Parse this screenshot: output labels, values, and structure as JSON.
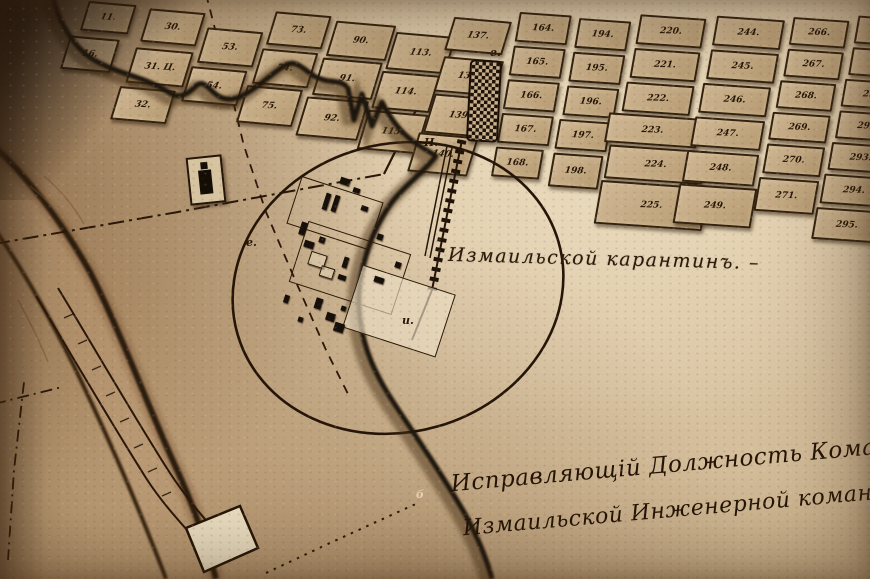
{
  "palette": {
    "paper": "#d9c3a2",
    "paper_light": "#e6d6b8",
    "paper_dark": "#ad8d67",
    "block_fill": "#c3a982",
    "ink": "#2a1708",
    "shadow": "#1a110a"
  },
  "labels": {
    "quarantine": "Измаильской карантинъ. –",
    "signature_line1": "Исправляющій Должность Командир",
    "signature_line2": "Измаильской Инженерной команды в"
  },
  "letter_marks": [
    {
      "text": "е.",
      "x": 490,
      "y": 46,
      "light": false
    },
    {
      "text": "Н.",
      "x": 424,
      "y": 136,
      "light": false
    },
    {
      "text": "и.",
      "x": 402,
      "y": 314,
      "light": false
    },
    {
      "text": "е.",
      "x": 246,
      "y": 236,
      "light": false
    },
    {
      "text": "б",
      "x": 416,
      "y": 488,
      "light": true
    }
  ],
  "left_grid": {
    "blocks": [
      {
        "label": "11.",
        "x": 34,
        "y": 0,
        "w": 44,
        "h": 26
      },
      {
        "label": "16.",
        "x": 26,
        "y": 36,
        "w": 46,
        "h": 30
      },
      {
        "label": "30.",
        "x": 96,
        "y": 2,
        "w": 52,
        "h": 30
      },
      {
        "label": "31. Ц.",
        "x": 94,
        "y": 42,
        "w": 54,
        "h": 32
      },
      {
        "label": "32.",
        "x": 90,
        "y": 82,
        "w": 52,
        "h": 30
      },
      {
        "label": "53.",
        "x": 158,
        "y": 16,
        "w": 52,
        "h": 32
      },
      {
        "label": "54.",
        "x": 154,
        "y": 56,
        "w": 52,
        "h": 32
      },
      {
        "label": "73.",
        "x": 220,
        "y": -6,
        "w": 52,
        "h": 30
      },
      {
        "label": "74.",
        "x": 218,
        "y": 32,
        "w": 52,
        "h": 32
      },
      {
        "label": "75.",
        "x": 214,
        "y": 70,
        "w": 52,
        "h": 34
      },
      {
        "label": "90.",
        "x": 282,
        "y": -2,
        "w": 56,
        "h": 32
      },
      {
        "label": "91.",
        "x": 280,
        "y": 36,
        "w": 56,
        "h": 34
      },
      {
        "label": "92.",
        "x": 276,
        "y": 76,
        "w": 58,
        "h": 36
      },
      {
        "label": "113.",
        "x": 344,
        "y": 4,
        "w": 56,
        "h": 34
      },
      {
        "label": "114.",
        "x": 342,
        "y": 44,
        "w": 54,
        "h": 34
      },
      {
        "label": "115.",
        "x": 340,
        "y": 84,
        "w": 56,
        "h": 36
      },
      {
        "label": "137.",
        "x": 396,
        "y": -16,
        "w": 54,
        "h": 30
      },
      {
        "label": "138.",
        "x": 398,
        "y": 24,
        "w": 56,
        "h": 32
      },
      {
        "label": "139.",
        "x": 400,
        "y": 62,
        "w": 58,
        "h": 36
      },
      {
        "label": "140.",
        "x": 396,
        "y": 102,
        "w": 56,
        "h": 36
      }
    ]
  },
  "right_grid": {
    "blocks": [
      {
        "label": "164.",
        "x": 0,
        "y": 12,
        "w": 48,
        "h": 26
      },
      {
        "label": "165.",
        "x": 0,
        "y": 46,
        "w": 48,
        "h": 26
      },
      {
        "label": "166.",
        "x": 0,
        "y": 80,
        "w": 48,
        "h": 26
      },
      {
        "label": "167.",
        "x": 0,
        "y": 114,
        "w": 48,
        "h": 26
      },
      {
        "label": "168.",
        "x": 0,
        "y": 148,
        "w": 44,
        "h": 26
      },
      {
        "label": "194.",
        "x": 60,
        "y": 14,
        "w": 48,
        "h": 26
      },
      {
        "label": "195.",
        "x": 60,
        "y": 48,
        "w": 48,
        "h": 26
      },
      {
        "label": "196.",
        "x": 60,
        "y": 82,
        "w": 48,
        "h": 26
      },
      {
        "label": "197.",
        "x": 58,
        "y": 116,
        "w": 48,
        "h": 26
      },
      {
        "label": "198.",
        "x": 58,
        "y": 150,
        "w": 46,
        "h": 30
      },
      {
        "label": "220.",
        "x": 120,
        "y": 6,
        "w": 62,
        "h": 26
      },
      {
        "label": "221.",
        "x": 120,
        "y": 40,
        "w": 62,
        "h": 26
      },
      {
        "label": "222.",
        "x": 118,
        "y": 74,
        "w": 64,
        "h": 26
      },
      {
        "label": "223.",
        "x": 106,
        "y": 106,
        "w": 88,
        "h": 26
      },
      {
        "label": "224.",
        "x": 112,
        "y": 138,
        "w": 94,
        "h": 30
      },
      {
        "label": "225.",
        "x": 110,
        "y": 174,
        "w": 104,
        "h": 40
      },
      {
        "label": "244.",
        "x": 196,
        "y": 2,
        "w": 64,
        "h": 26
      },
      {
        "label": "245.",
        "x": 196,
        "y": 36,
        "w": 64,
        "h": 26
      },
      {
        "label": "246.",
        "x": 194,
        "y": 70,
        "w": 64,
        "h": 26
      },
      {
        "label": "247.",
        "x": 192,
        "y": 104,
        "w": 66,
        "h": 26
      },
      {
        "label": "248.",
        "x": 190,
        "y": 138,
        "w": 68,
        "h": 28
      },
      {
        "label": "249.",
        "x": 188,
        "y": 172,
        "w": 74,
        "h": 36
      },
      {
        "label": "266.",
        "x": 272,
        "y": -2,
        "w": 52,
        "h": 24
      },
      {
        "label": "267.",
        "x": 272,
        "y": 30,
        "w": 52,
        "h": 24
      },
      {
        "label": "268.",
        "x": 270,
        "y": 62,
        "w": 52,
        "h": 24
      },
      {
        "label": "269.",
        "x": 268,
        "y": 94,
        "w": 54,
        "h": 24
      },
      {
        "label": "270.",
        "x": 268,
        "y": 126,
        "w": 54,
        "h": 26
      },
      {
        "label": "271.",
        "x": 266,
        "y": 160,
        "w": 56,
        "h": 30
      },
      {
        "label": "289.",
        "x": 336,
        "y": -8,
        "w": 58,
        "h": 24
      },
      {
        "label": "290.",
        "x": 336,
        "y": 24,
        "w": 58,
        "h": 24
      },
      {
        "label": "291.",
        "x": 334,
        "y": 56,
        "w": 58,
        "h": 24
      },
      {
        "label": "292.",
        "x": 334,
        "y": 88,
        "w": 58,
        "h": 24
      },
      {
        "label": "293.",
        "x": 332,
        "y": 120,
        "w": 58,
        "h": 24
      },
      {
        "label": "294.",
        "x": 330,
        "y": 152,
        "w": 60,
        "h": 26
      },
      {
        "label": "295.",
        "x": 328,
        "y": 186,
        "w": 62,
        "h": 28
      }
    ]
  },
  "quarantine_compound": {
    "outlines": [
      {
        "x": 292,
        "y": 188,
        "w": 84,
        "h": 48,
        "r": 18,
        "fill": false
      },
      {
        "x": 296,
        "y": 236,
        "w": 106,
        "h": 62,
        "r": 18,
        "fill": false
      },
      {
        "x": 350,
        "y": 278,
        "w": 96,
        "h": 64,
        "r": 18,
        "fill": true
      }
    ],
    "buildings": [
      {
        "x": 340,
        "y": 178,
        "w": 10,
        "h": 7,
        "r": 18,
        "solid": true
      },
      {
        "x": 324,
        "y": 193,
        "w": 5,
        "h": 17,
        "r": 18,
        "solid": true
      },
      {
        "x": 333,
        "y": 195,
        "w": 5,
        "h": 17,
        "r": 18,
        "solid": true
      },
      {
        "x": 353,
        "y": 188,
        "w": 7,
        "h": 5,
        "r": 18,
        "solid": true
      },
      {
        "x": 361,
        "y": 206,
        "w": 7,
        "h": 5,
        "r": 18,
        "solid": true
      },
      {
        "x": 300,
        "y": 222,
        "w": 6,
        "h": 13,
        "r": 18,
        "solid": true
      },
      {
        "x": 304,
        "y": 241,
        "w": 10,
        "h": 7,
        "r": 18,
        "solid": true
      },
      {
        "x": 319,
        "y": 237,
        "w": 6,
        "h": 6,
        "r": 18,
        "solid": true
      },
      {
        "x": 377,
        "y": 234,
        "w": 6,
        "h": 6,
        "r": 18,
        "solid": true
      },
      {
        "x": 395,
        "y": 262,
        "w": 6,
        "h": 6,
        "r": 18,
        "solid": true
      },
      {
        "x": 374,
        "y": 277,
        "w": 10,
        "h": 6,
        "r": 18,
        "solid": true
      },
      {
        "x": 343,
        "y": 257,
        "w": 5,
        "h": 11,
        "r": 18,
        "solid": true
      },
      {
        "x": 338,
        "y": 275,
        "w": 8,
        "h": 5,
        "r": 18,
        "solid": true
      },
      {
        "x": 315,
        "y": 298,
        "w": 7,
        "h": 11,
        "r": 18,
        "solid": true
      },
      {
        "x": 326,
        "y": 313,
        "w": 9,
        "h": 8,
        "r": 18,
        "solid": true
      },
      {
        "x": 341,
        "y": 306,
        "w": 5,
        "h": 5,
        "r": 18,
        "solid": true
      },
      {
        "x": 284,
        "y": 295,
        "w": 5,
        "h": 8,
        "r": 18,
        "solid": true
      },
      {
        "x": 334,
        "y": 323,
        "w": 10,
        "h": 9,
        "r": 18,
        "solid": true
      },
      {
        "x": 298,
        "y": 317,
        "w": 5,
        "h": 5,
        "r": 18,
        "solid": true
      },
      {
        "x": 309,
        "y": 253,
        "w": 15,
        "h": 12,
        "r": 18,
        "solid": false
      },
      {
        "x": 320,
        "y": 267,
        "w": 12,
        "h": 9,
        "r": 18,
        "solid": false
      }
    ]
  }
}
